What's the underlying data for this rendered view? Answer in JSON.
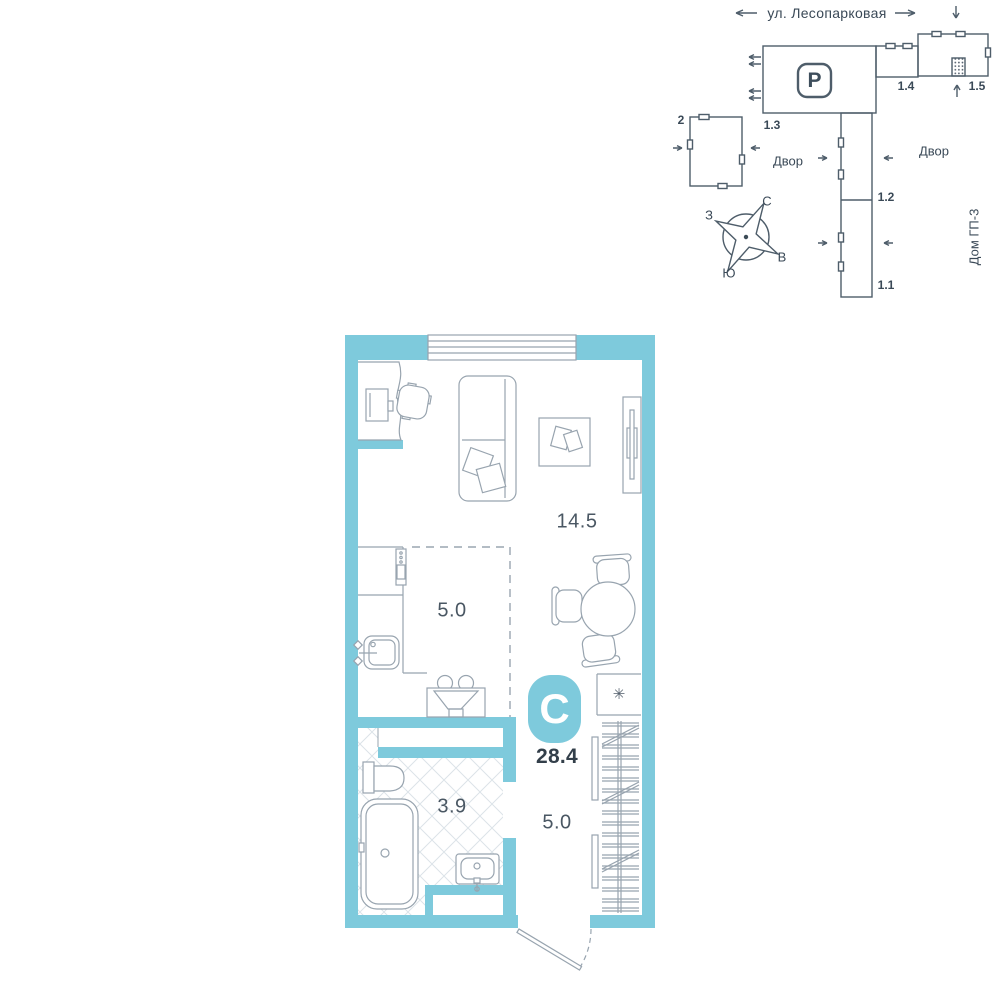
{
  "colors": {
    "wall_teal": "#7ecadc",
    "site_line": "#4e5d6a",
    "furniture_line": "#98a4af",
    "text_dark": "#3a4957",
    "tile_hatch": "#dce3e8"
  },
  "site_plan": {
    "street_label": "ул. Лесопарковая",
    "yard_label_left": "Двор",
    "yard_label_right": "Двор",
    "house_label": "Дом ГП-3",
    "parking_label": "P",
    "building_labels": {
      "b2": "2",
      "b1_3": "1.3",
      "b1_4": "1.4",
      "b1_5": "1.5",
      "b1_2": "1.2",
      "b1_1": "1.1"
    },
    "compass": {
      "north": "С",
      "south": "Ю",
      "west": "З",
      "east": "В"
    }
  },
  "floor_plan": {
    "type_badge": "С",
    "total_area": "28.4",
    "areas": {
      "living_room": "14.5",
      "kitchen": "5.0",
      "bathroom": "3.9",
      "hallway": "5.0"
    },
    "appliance_symbol": "✳"
  }
}
